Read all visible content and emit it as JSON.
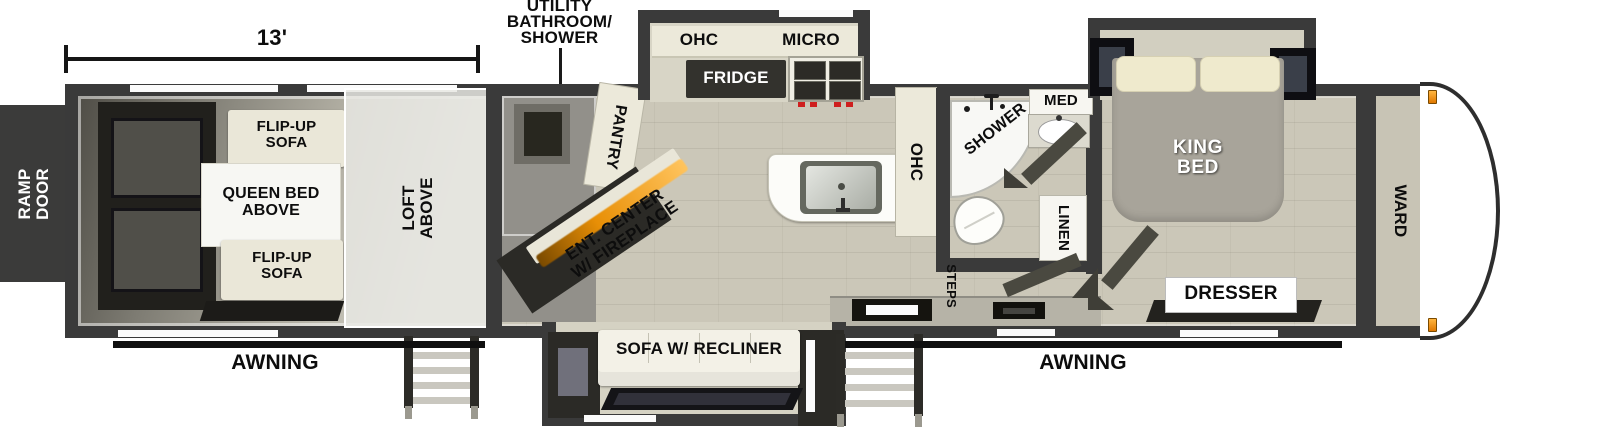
{
  "colors": {
    "walls": "#3a3a3a",
    "floor": "#cbc7b8",
    "cabinets": "#ece9da",
    "fireplace_orange": "#e88f06",
    "bed_gray": "#a8a49a",
    "marker_orange": "#f0940f",
    "label_text": "#0d0d0d",
    "exterior_lines": "#111111"
  },
  "dimension": {
    "length": "13'"
  },
  "callout": {
    "line1": "UTILITY",
    "line2": "BATHROOM/",
    "line3": "SHOWER"
  },
  "exterior": {
    "ramp_door_line1": "RAMP",
    "ramp_door_line2": "DOOR",
    "awning_left": "AWNING",
    "awning_right": "AWNING"
  },
  "garage": {
    "flip_up_sofa_top_line1": "FLIP-UP",
    "flip_up_sofa_top_line2": "SOFA",
    "queen_bed_line1": "QUEEN BED",
    "queen_bed_line2": "ABOVE",
    "flip_up_sofa_bottom_line1": "FLIP-UP",
    "flip_up_sofa_bottom_line2": "SOFA",
    "loft_line1": "LOFT",
    "loft_line2": "ABOVE"
  },
  "kitchen": {
    "pantry": "PANTRY",
    "ohc_upper": "OHC",
    "micro": "MICRO",
    "fridge": "FRIDGE",
    "ent_center_line1": "ENT. CENTER",
    "ent_center_line2": "W/ FIREPLACE",
    "ohc_counter": "OHC"
  },
  "bathroom": {
    "shower": "SHOWER",
    "med": "MED",
    "linen": "LINEN",
    "steps": "STEPS"
  },
  "bedroom": {
    "king_bed_line1": "KING",
    "king_bed_line2": "BED",
    "dresser": "DRESSER",
    "wardrobe": "WARD"
  },
  "living": {
    "sofa": "SOFA W/ RECLINER"
  }
}
